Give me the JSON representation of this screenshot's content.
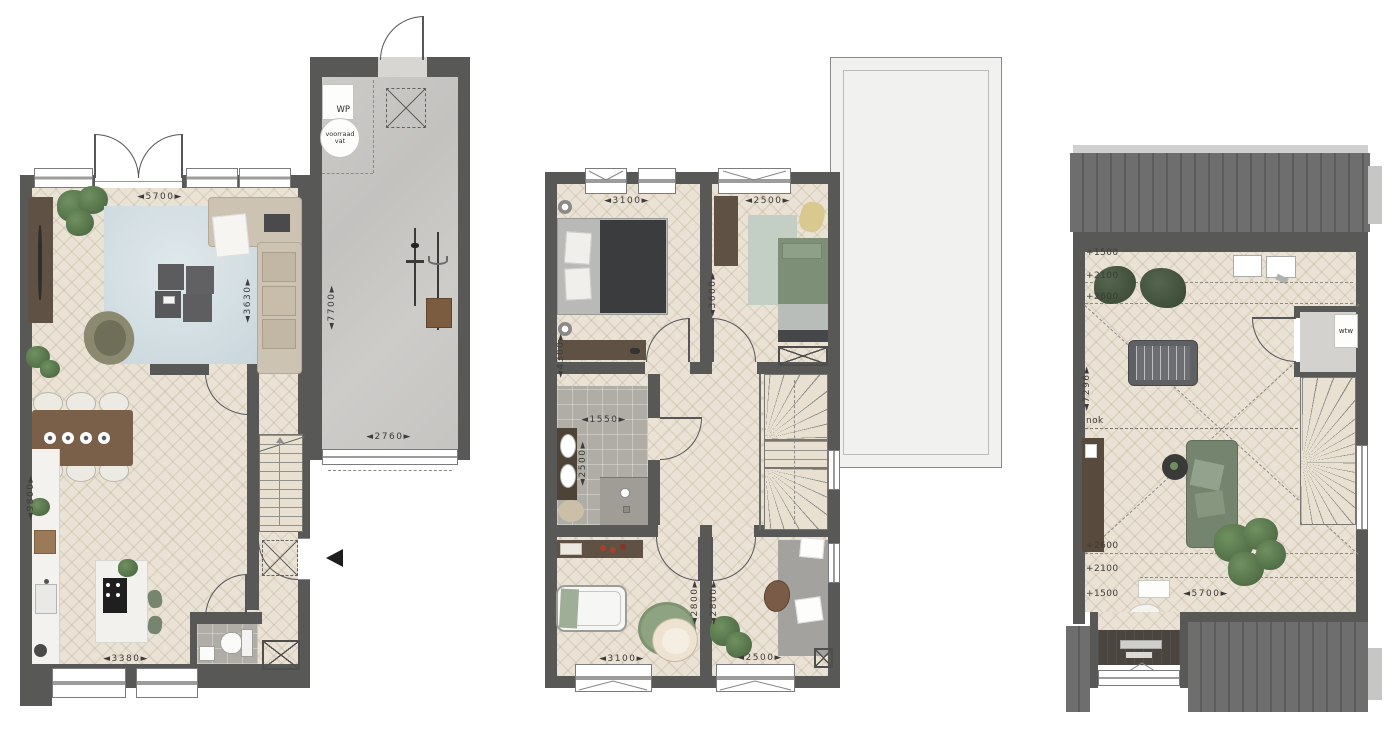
{
  "document": {
    "type": "floor-plan-set",
    "floors": [
      "ground floor",
      "first floor",
      "second floor"
    ]
  },
  "palette": {
    "wall": "#585856",
    "wood_floor": "#eae2d4",
    "concrete": "#c9c8c5",
    "tile": "#b0ada6",
    "roof": "#6d6e6d",
    "flat_roof": "#f1f1f0",
    "dim_text": "#3c3c3a",
    "green_accent": "#75846e"
  },
  "ground_floor": {
    "dims": {
      "living_width": "◄5700►",
      "living_depth": "◄3630►",
      "garage_depth": "◄7700►",
      "garage_width": "◄2760►",
      "total_depth": "◄9800►",
      "kitchen_width": "◄3380►"
    },
    "labels": {
      "heat_pump": "WP",
      "storage_vessel": "voorraad vat"
    }
  },
  "first_floor": {
    "dims": {
      "bedroom1_width": "◄3100►",
      "bedroom2_width": "◄2500►",
      "bedroom1_depth": "◄4300►",
      "bedroom2_depth": "◄3600►",
      "bathroom_width": "◄1550►",
      "bathroom_depth": "◄2500►",
      "bedroom3_depth": "◄2800►",
      "bedroom4_depth": "◄2800►",
      "bedroom3_width": "◄3100►",
      "bedroom4_width": "◄2500►"
    }
  },
  "second_floor": {
    "dims": {
      "floor_depth": "◄7296►",
      "floor_width": "◄5700►"
    },
    "height_lines_top": [
      "+1500",
      "+2100",
      "+2600"
    ],
    "height_lines_bottom": [
      "+2600",
      "+2100",
      "+1500"
    ],
    "labels": {
      "ridge": "nok",
      "heat_recovery": "wtw"
    }
  }
}
